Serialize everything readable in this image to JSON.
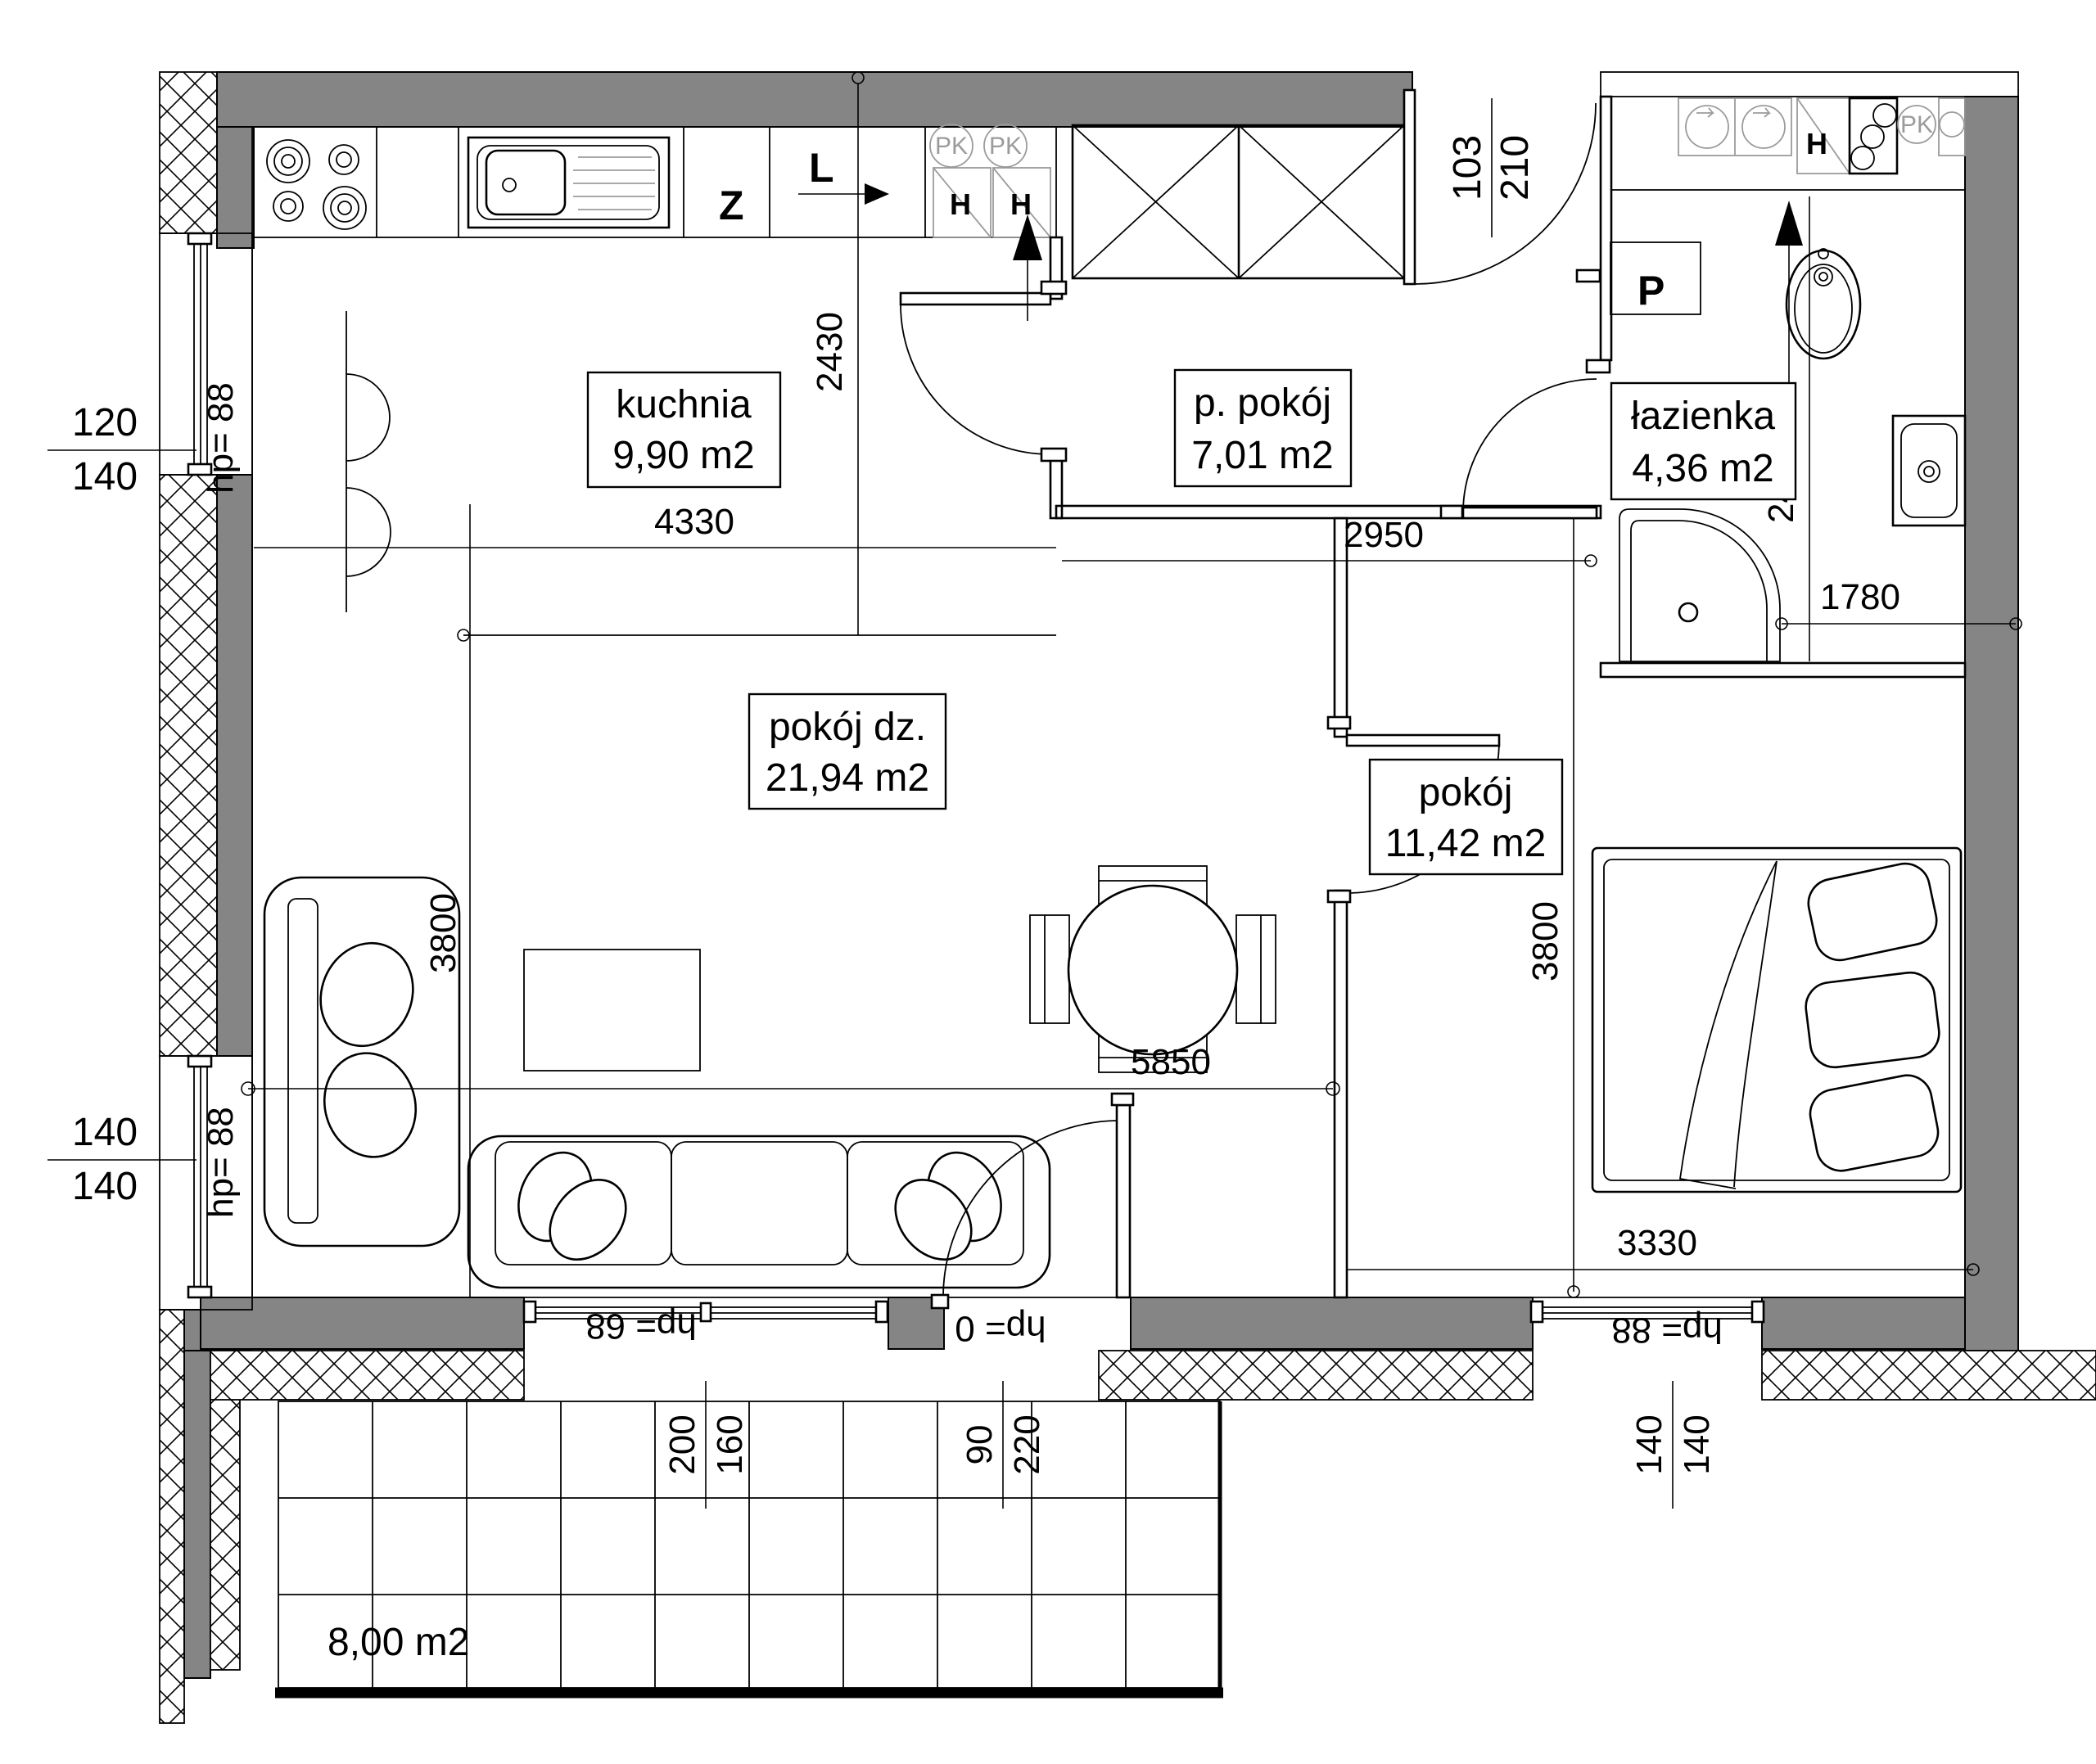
{
  "rooms": {
    "kuchnia": {
      "name": "kuchnia",
      "area": "9,90 m2"
    },
    "przedpokoj": {
      "name": "p. pokój",
      "area": "7,01 m2"
    },
    "lazienka": {
      "name": "łazienka",
      "area": "4,36 m2"
    },
    "pokoj_dzienny": {
      "name": "pokój dz.",
      "area": "21,94 m2"
    },
    "pokoj": {
      "name": "pokój",
      "area": "11,42 m2"
    },
    "balkon": {
      "area": "8,00 m2"
    }
  },
  "dimensions": {
    "kitchen_width": "4330",
    "kitchen_depth": "2430",
    "hall_width": "2950",
    "bath_depth": "2490",
    "bath_width": "1780",
    "living_width": "5850",
    "living_depth": "3800",
    "bedroom_depth": "3800",
    "bedroom_width": "3330"
  },
  "openings": {
    "entrance": {
      "width": "103",
      "height": "210"
    },
    "window_left_top": {
      "width": "120",
      "height": "140",
      "sill": "hp= 88"
    },
    "window_left_bottom": {
      "width": "140",
      "height": "140",
      "sill": "hp= 88"
    },
    "window_living": {
      "width": "200",
      "height": "160",
      "sill": "hp= 68"
    },
    "balcony_door": {
      "width": "90",
      "height": "220",
      "sill": "hp= 0"
    },
    "window_bedroom": {
      "width": "140",
      "height": "140",
      "sill": "hp= 88"
    }
  },
  "symbols": {
    "sink": "Z",
    "vent": "L",
    "washing_machine": "P",
    "heater": "H",
    "pk": "PK"
  }
}
